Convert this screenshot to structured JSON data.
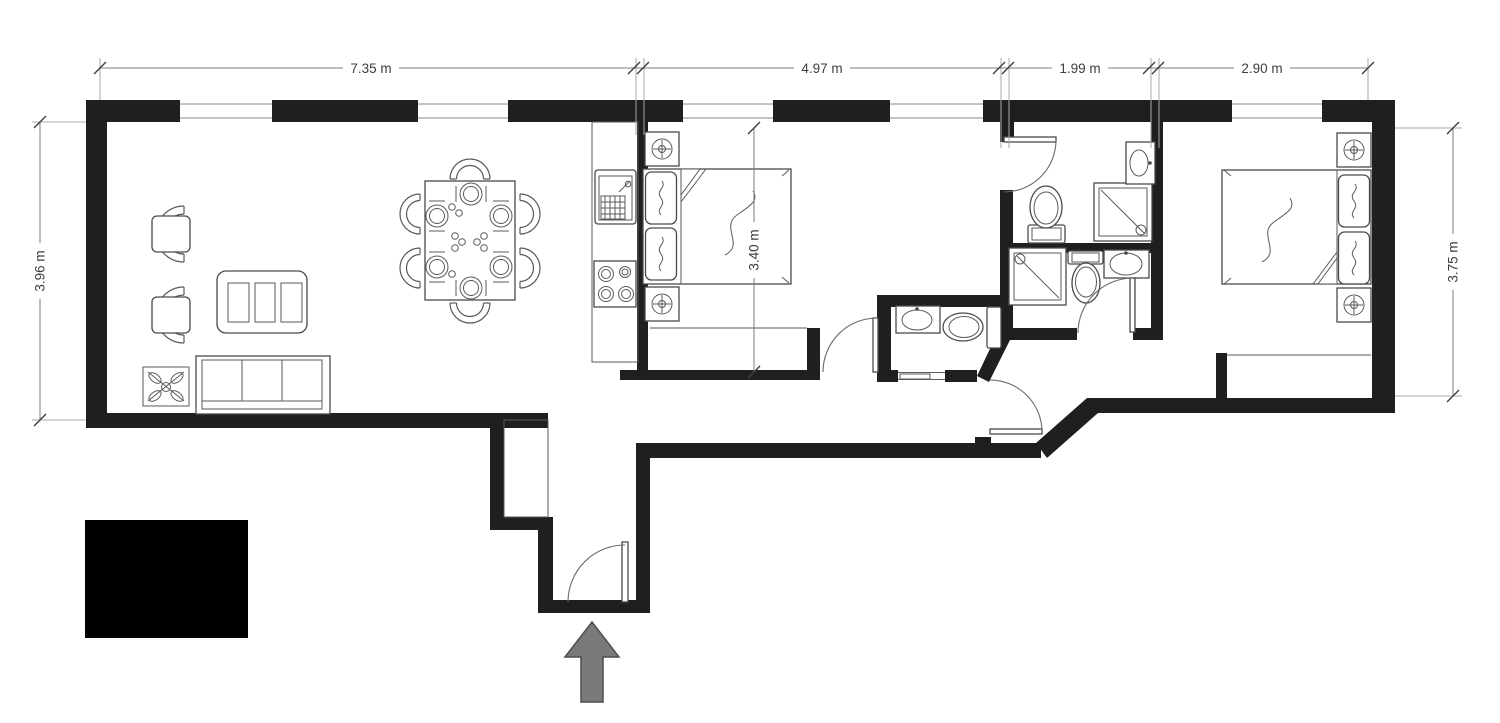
{
  "title": "apartment-floor-plan",
  "colors": {
    "background": "#ffffff",
    "wall": "#1f1f1f",
    "furniture_stroke": "#4a4a4a",
    "dimension_text": "#3d3d3d",
    "entry_arrow_fill": "#7a7a7a",
    "entry_arrow_stroke": "#4d4d4d",
    "redaction_block": "#000000"
  },
  "dimensions": {
    "top": [
      {
        "label": "7.35 m"
      },
      {
        "label": "4.97 m"
      },
      {
        "label": "1.99 m"
      },
      {
        "label": "2.90 m"
      }
    ],
    "left": {
      "label": "3.96 m"
    },
    "interior_bedroom": {
      "label": "3.40 m"
    },
    "right": {
      "label": "3.75 m"
    }
  },
  "symbols": [
    "armchair",
    "armchair",
    "coffee-table",
    "sofa",
    "plant",
    "dining-table",
    "dining-chair-x6",
    "place-setting-x6",
    "kitchen-counter",
    "kitchen-sink",
    "stove-4-burners",
    "double-bed",
    "nightstand-lamp-x4",
    "wardrobe",
    "wardrobe",
    "toilet-x3",
    "shower-x3",
    "washbasin-x3",
    "door-swing-x6",
    "sliding-door",
    "window-x5",
    "entrance-arrow",
    "redaction-block"
  ]
}
